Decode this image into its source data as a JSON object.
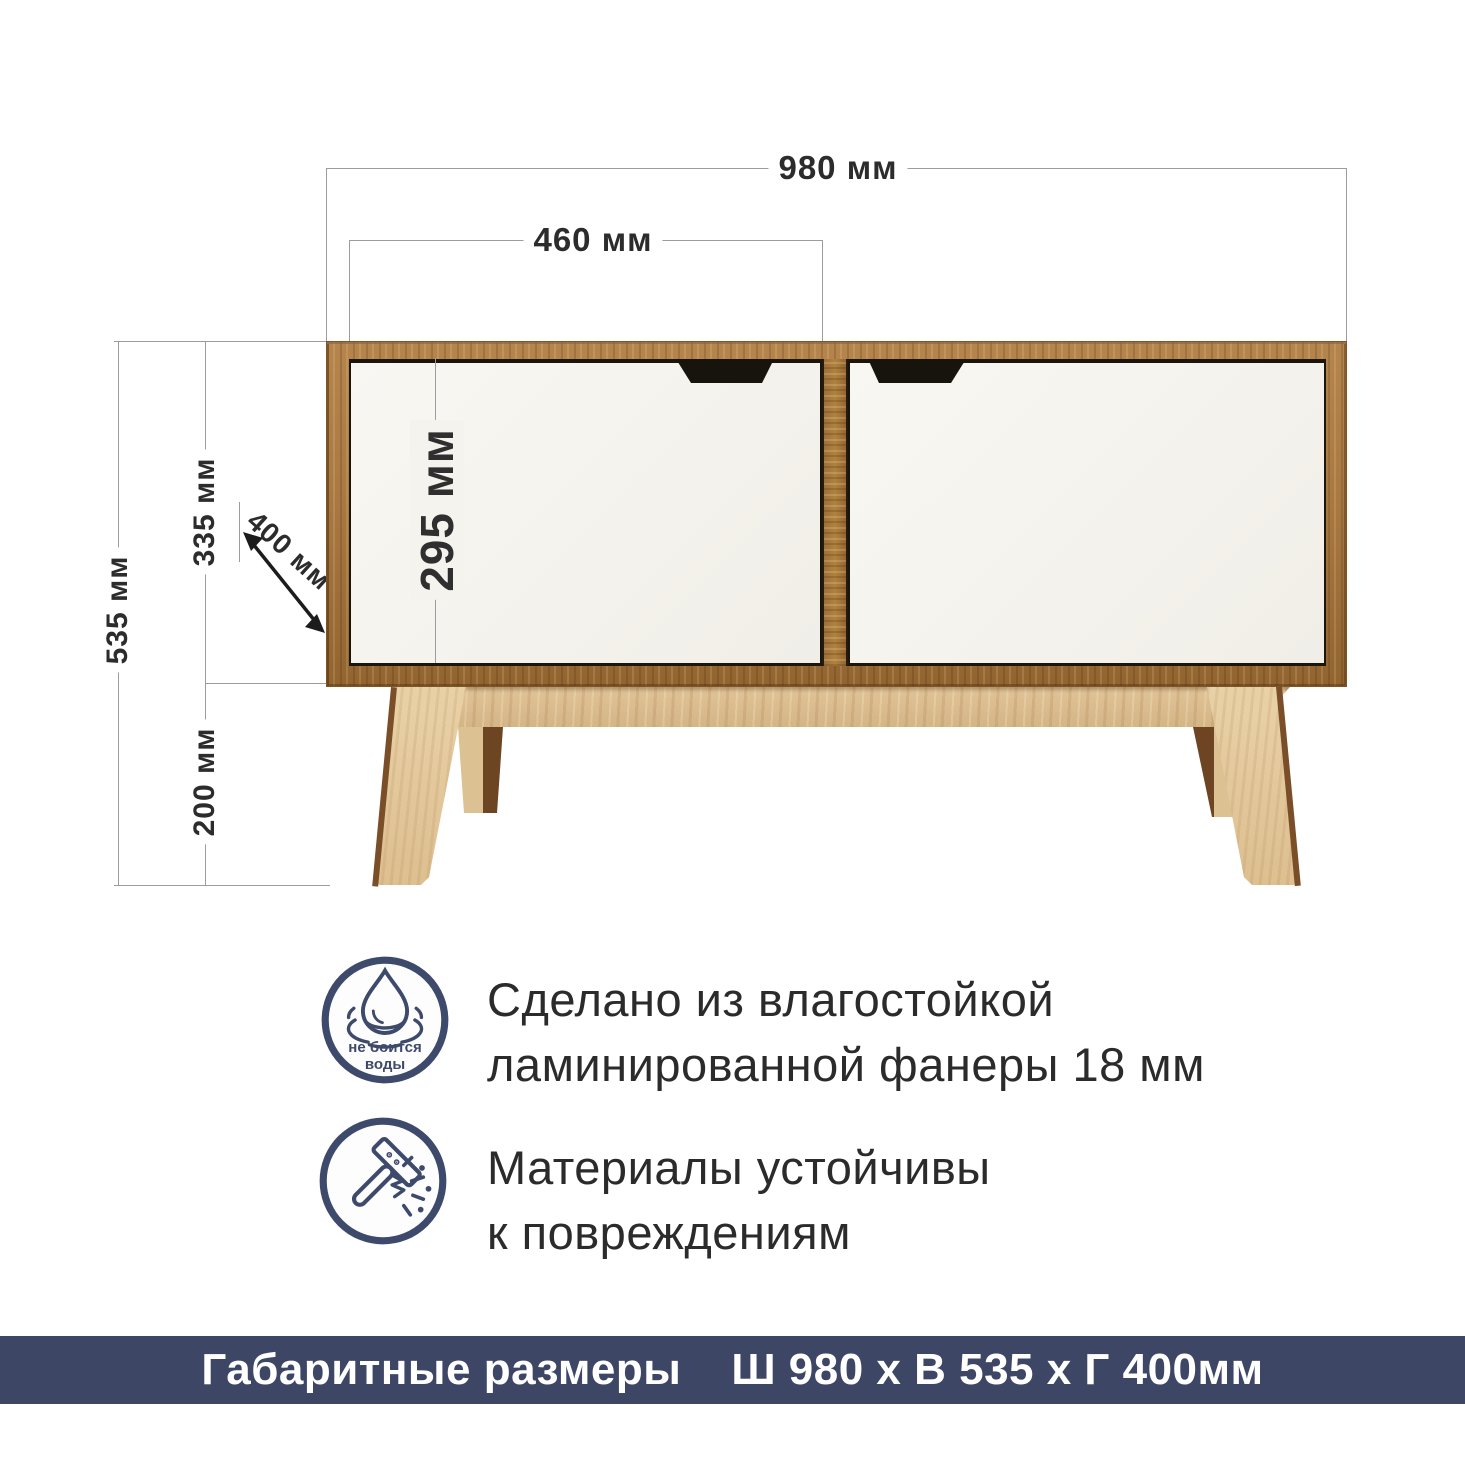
{
  "dimensions": {
    "total_width": "980 мм",
    "door_width": "460 мм",
    "door_height": "295 мм",
    "body_height": "335 мм",
    "total_height": "535 мм",
    "leg_height": "200 мм",
    "depth": "400 мм"
  },
  "features": {
    "water_badge_line1": "не боится",
    "water_badge_line2": "воды",
    "water_line1": "Сделано из влагостойкой",
    "water_line2": "ламинированной фанеры 18 мм",
    "impact_line1": "Материалы устойчивы",
    "impact_line2": "к повреждениям"
  },
  "footer": {
    "label": "Габаритные размеры",
    "value": "Ш 980 х В 535 х Г 400мм"
  },
  "icons": {
    "water": "water-drop-icon",
    "impact": "hammer-icon"
  },
  "colors": {
    "accent_navy": "#3e4a6b",
    "banner_bg": "#3e4665",
    "dimension_line": "#9c9c9c",
    "dimension_text": "#2c2c2c",
    "wood_frame": "#a97943",
    "wood_light": "#e2c79c",
    "door_white": "#f6f4ef",
    "handle_black": "#17130d"
  }
}
